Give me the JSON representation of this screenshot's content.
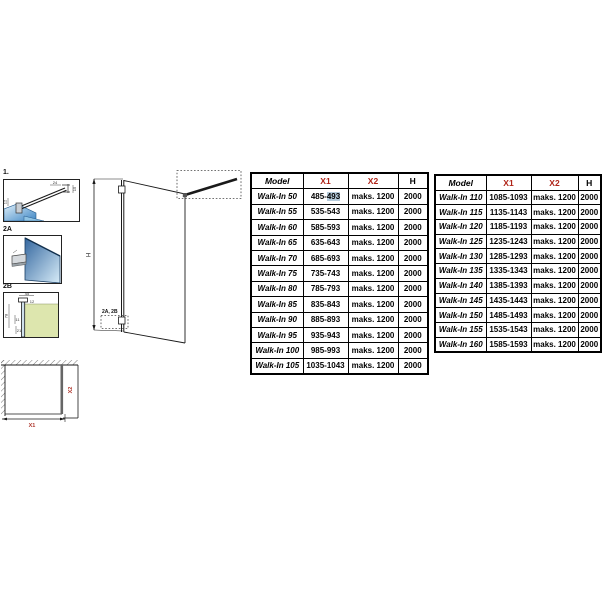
{
  "page": {
    "background": "#ffffff"
  },
  "colors": {
    "accent_red": "#b02418",
    "table_border": "#000000",
    "glass_blue_dark": "#34679f",
    "glass_blue_light": "#d7ecf8",
    "wall_olive": "#dde6ae",
    "selection_highlight": "#b5cbdb"
  },
  "details": {
    "detail1": {
      "label": "1.",
      "dim_top": "24",
      "dim_right": "15",
      "dim_left": "12"
    },
    "detail2a": {
      "label": "2A"
    },
    "detail2b": {
      "label": "2B",
      "dim_top": "45",
      "dim_top2": "12",
      "dim_left": "78",
      "dim_mid": "11",
      "dim_bottom": "21"
    }
  },
  "elevation": {
    "height_label": "H",
    "callout_label": "2A, 2B"
  },
  "plan": {
    "width_label": "X1",
    "depth_label": "X2"
  },
  "selection": {
    "table_index": 0,
    "row": 0,
    "col": 1,
    "text": "493"
  },
  "tables": [
    {
      "headers": [
        "Model",
        "X1",
        "X2",
        "H"
      ],
      "rows": [
        [
          "Walk-In 50",
          "485-493",
          "maks. 1200",
          "2000"
        ],
        [
          "Walk-In 55",
          "535-543",
          "maks. 1200",
          "2000"
        ],
        [
          "Walk-In 60",
          "585-593",
          "maks. 1200",
          "2000"
        ],
        [
          "Walk-In 65",
          "635-643",
          "maks. 1200",
          "2000"
        ],
        [
          "Walk-In 70",
          "685-693",
          "maks. 1200",
          "2000"
        ],
        [
          "Walk-In 75",
          "735-743",
          "maks. 1200",
          "2000"
        ],
        [
          "Walk-In 80",
          "785-793",
          "maks. 1200",
          "2000"
        ],
        [
          "Walk-In 85",
          "835-843",
          "maks. 1200",
          "2000"
        ],
        [
          "Walk-In 90",
          "885-893",
          "maks. 1200",
          "2000"
        ],
        [
          "Walk-In 95",
          "935-943",
          "maks. 1200",
          "2000"
        ],
        [
          "Walk-In 100",
          "985-993",
          "maks. 1200",
          "2000"
        ],
        [
          "Walk-In 105",
          "1035-1043",
          "maks. 1200",
          "2000"
        ]
      ]
    },
    {
      "headers": [
        "Model",
        "X1",
        "X2",
        "H"
      ],
      "rows": [
        [
          "Walk-In 110",
          "1085-1093",
          "maks. 1200",
          "2000"
        ],
        [
          "Walk-In 115",
          "1135-1143",
          "maks. 1200",
          "2000"
        ],
        [
          "Walk-In 120",
          "1185-1193",
          "maks. 1200",
          "2000"
        ],
        [
          "Walk-In 125",
          "1235-1243",
          "maks. 1200",
          "2000"
        ],
        [
          "Walk-In 130",
          "1285-1293",
          "maks. 1200",
          "2000"
        ],
        [
          "Walk-In 135",
          "1335-1343",
          "maks. 1200",
          "2000"
        ],
        [
          "Walk-In 140",
          "1385-1393",
          "maks. 1200",
          "2000"
        ],
        [
          "Walk-In 145",
          "1435-1443",
          "maks. 1200",
          "2000"
        ],
        [
          "Walk-In 150",
          "1485-1493",
          "maks. 1200",
          "2000"
        ],
        [
          "Walk-In 155",
          "1535-1543",
          "maks. 1200",
          "2000"
        ],
        [
          "Walk-In 160",
          "1585-1593",
          "maks. 1200",
          "2000"
        ]
      ]
    }
  ]
}
